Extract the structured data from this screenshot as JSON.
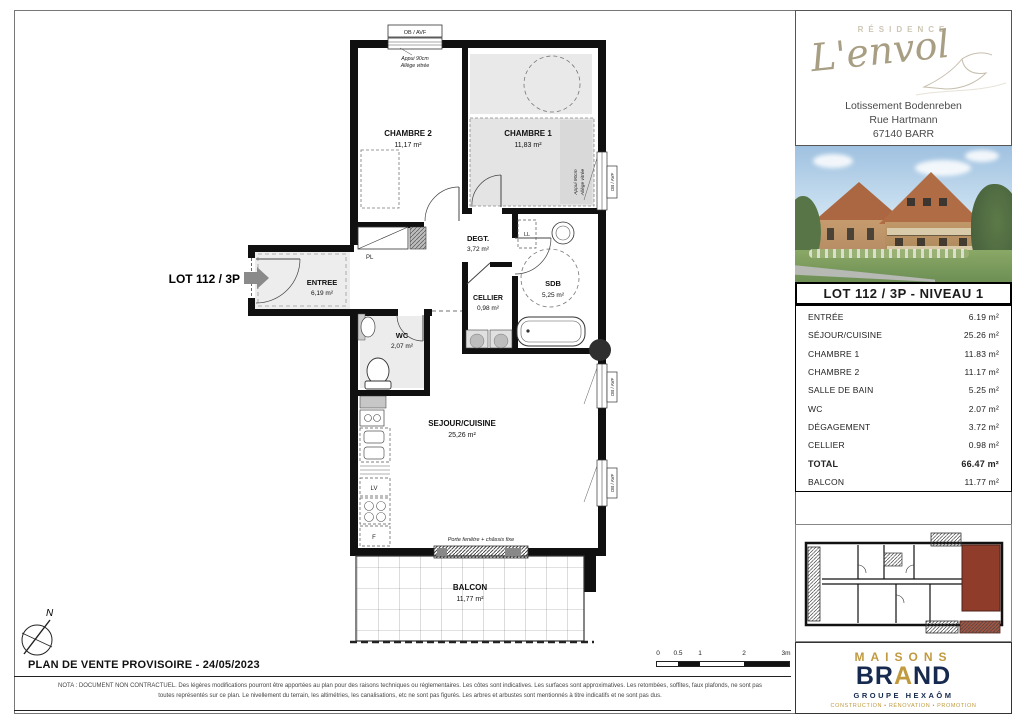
{
  "plan": {
    "lot_label": "LOT 112 / 3P",
    "north": "N",
    "rooms": [
      {
        "name": "CHAMBRE 2",
        "area": "11,17 m²"
      },
      {
        "name": "CHAMBRE 1",
        "area": "11,83 m²"
      },
      {
        "name": "DEGT.",
        "area": "3,72 m²"
      },
      {
        "name": "ENTREE",
        "area": "6,19 m²"
      },
      {
        "name": "WC",
        "area": "2,07 m²"
      },
      {
        "name": "CELLIER",
        "area": "0,98 m²"
      },
      {
        "name": "SDB",
        "area": "5,25 m²"
      },
      {
        "name": "SEJOUR/CUISINE",
        "area": "25,26 m²"
      },
      {
        "name": "BALCON",
        "area": "11,77 m²"
      }
    ],
    "labels": {
      "ob_avf": "OB / AVF",
      "appui": "Appui 90cm",
      "allege": "Allège vitrée",
      "pl": "PL",
      "ll": "LL",
      "lv": "LV",
      "f": "F",
      "porte_fenetre": "Porte fenêtre + châssis fixe"
    }
  },
  "footer": {
    "title": "PLAN DE VENTE PROVISOIRE - 24/05/2023",
    "nota_line1": "NOTA : DOCUMENT NON CONTRACTUEL. Des légères modifications pourront être apportées au plan pour des raisons techniques ou réglementaires. Les côtes sont indicatives. Les surfaces sont approximatives. Les retombées, soffites, faux plafonds, ne sont pas",
    "nota_line2": "toutes représentés sur ce plan. Le nivellement du terrain, les altimétries, les canalisations, etc ne sont pas figurés. Les arbres et arbustes sont mentionnés à titre indicatifs et ne sont pas dus.",
    "scale_ticks": [
      "0",
      "0.5",
      "1",
      "2",
      "3m"
    ]
  },
  "sidebar": {
    "residence_label": "RÉSIDENCE",
    "residence_name": "L'envol",
    "address": [
      "Lotissement Bodenreben",
      "Rue Hartmann",
      "67140 BARR"
    ],
    "lot_header": "LOT 112 / 3P - NIVEAU 1",
    "table": {
      "rows": [
        {
          "label": "ENTRÉE",
          "value": "6.19 m²"
        },
        {
          "label": "SÉJOUR/CUISINE",
          "value": "25.26 m²"
        },
        {
          "label": "CHAMBRE 1",
          "value": "11.83 m²"
        },
        {
          "label": "CHAMBRE 2",
          "value": "11.17 m²"
        },
        {
          "label": "SALLE DE BAIN",
          "value": "5.25 m²"
        },
        {
          "label": "WC",
          "value": "2.07 m²"
        },
        {
          "label": "DÉGAGEMENT",
          "value": "3.72 m²"
        },
        {
          "label": "CELLIER",
          "value": "0.98 m²"
        },
        {
          "label": "TOTAL",
          "value": "66.47 m²",
          "bold": true
        },
        {
          "label": "BALCON",
          "value": "11.77 m²"
        }
      ]
    },
    "brand": {
      "maisons": "MAISONS",
      "brand_a": "BR",
      "brand_b": "A",
      "brand_c": "ND",
      "groupe": "GROUPE HEXAÔM",
      "tagline": "CONSTRUCTION • RÉNOVATION • PROMOTION"
    },
    "colors": {
      "accent_gold": "#c19a3f",
      "navy": "#16294e",
      "unit_highlight": "#8f3c2b"
    }
  }
}
